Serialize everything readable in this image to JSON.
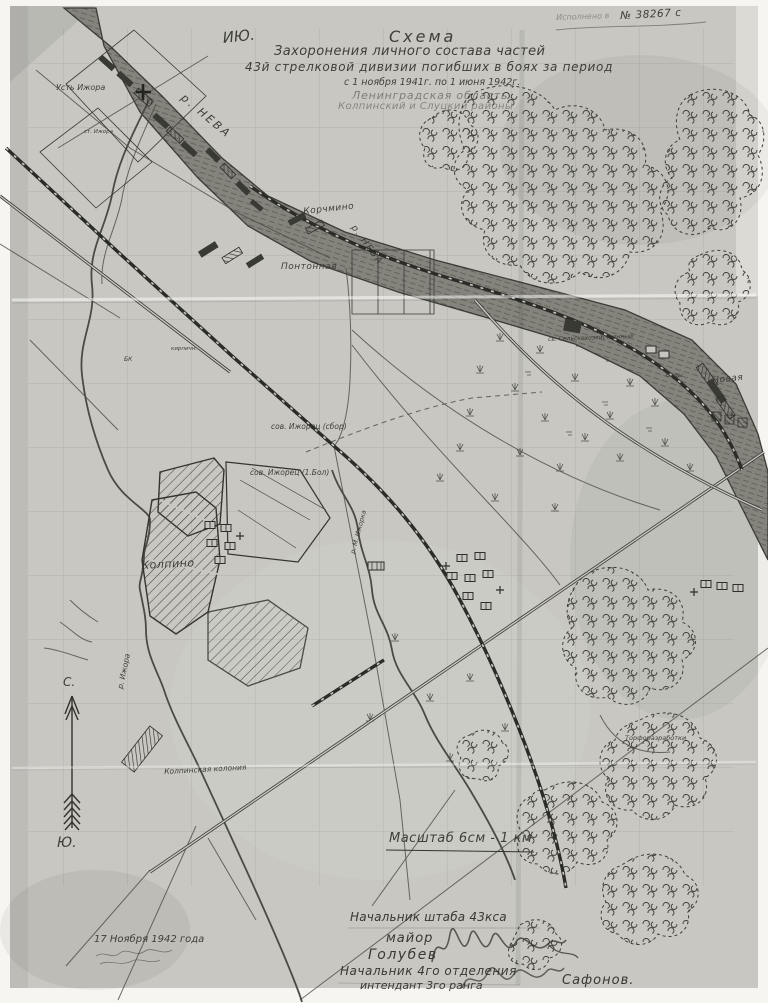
{
  "document": {
    "stamp_prefix": "Исполнено в",
    "stamp_number": "№ 38267 с",
    "corner_mark": "ИЮ."
  },
  "title": {
    "line1": "Схема",
    "line2": "Захоронения личного состава частей",
    "line3": "43й стрелковой дивизии погибших в боях за период",
    "line4": "с 1 ноября 1941г. по 1 июня 1942г.",
    "region": "Ленинградская область",
    "districts": "Колпинский и Слуцкий районы"
  },
  "map_labels": {
    "ust_izhora": "Усть Ижора",
    "r_neva_upper": "р. НЕВА",
    "r_neva_lower": "р. НЕВА",
    "st_izhora": "ст. Ижора",
    "korchmino": "Корчмино",
    "pontonnaya": "Понтонная",
    "kirpichny": "кирпичн.",
    "bk": "БК",
    "selhoz": "св. Сельскохозяйственный",
    "sady": "Сады",
    "novaya": "Новая",
    "izhorets_1": "сов. Ижорец (сбор)",
    "izhorets_2": "сов. Ижорец (1.Бол)",
    "kolpino": "Колпино",
    "m_izhorka": "р. М. Ижорка",
    "r_izhora": "р. Ижора",
    "kolonia": "Колпинская колония",
    "torf": "Торфоразработки"
  },
  "compass": {
    "north": "С.",
    "south": "Ю."
  },
  "scale_bar": {
    "text": "Масштаб 6см - 1 км"
  },
  "date_note": {
    "text": "17 Ноября 1942 года"
  },
  "signatures": {
    "row1": "Начальник штаба 43кса",
    "row2": "майор",
    "row3": "Голубев",
    "row4": "Начальник 4го отделения",
    "row5": "интендант 3го ранга",
    "row6": "Сафонов."
  },
  "colors": {
    "paper": "#c8c7c1",
    "ink": "#2e2e2a",
    "river": "#85847c"
  }
}
